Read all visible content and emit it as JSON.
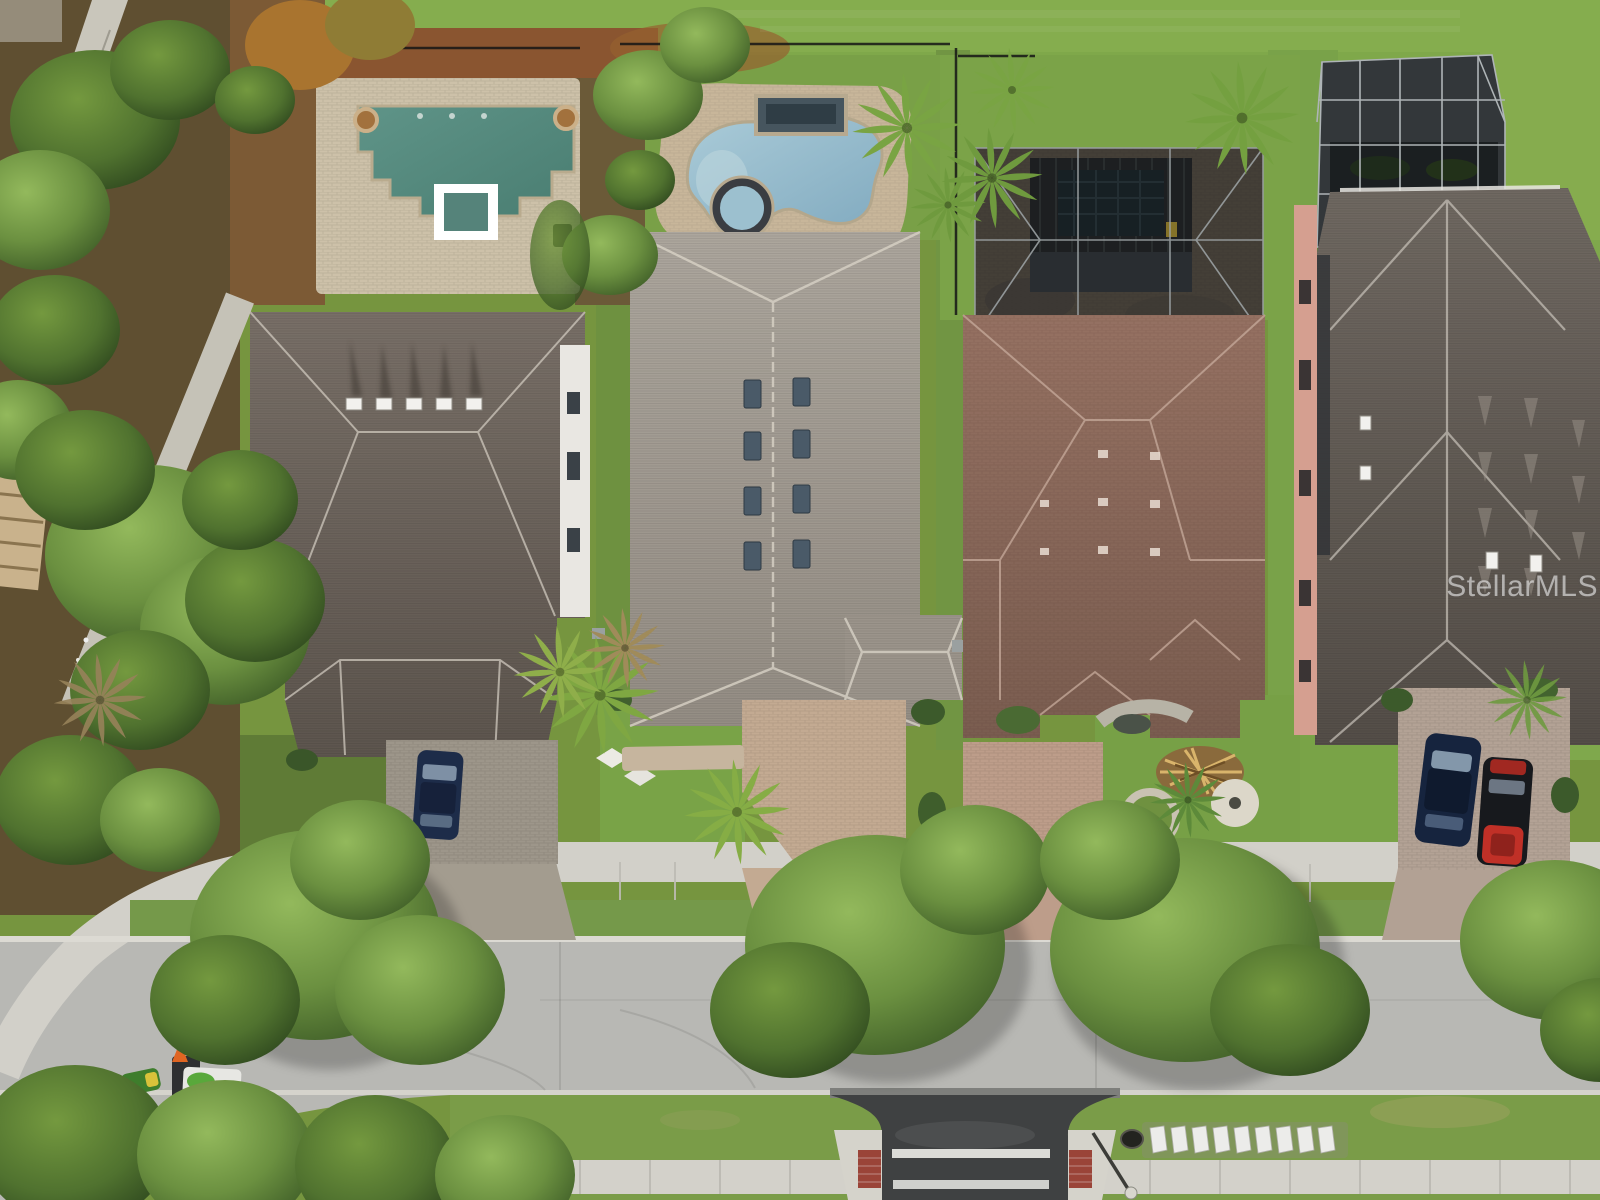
{
  "photo": {
    "kind": "aerial-drone-top-down",
    "subject": "Top-down aerial view of four suburban homes with backyard pools along a tree-lined residential street"
  },
  "watermark": {
    "text": "StellarMLS",
    "color": "#ffffff",
    "opacity": 0.55
  },
  "palette": {
    "lawn": "#7aa347",
    "lawn_bright": "#86ad4e",
    "mulch": "#6a5533",
    "street": "#b8b8b4",
    "sidewalk": "#d3d1ca",
    "pool1_water": "#558a7d",
    "pool2_water": "#9dc3d4",
    "pool_deck_paver": "#cdc1a9",
    "roof_house1": "#6e655d",
    "roof_house2": "#a39d94",
    "roof_house3": "#8a695a",
    "roof_house4": "#665f58",
    "screen_cage": "#33373a",
    "salmon_wall": "#d59f90",
    "white_wall": "#e9e7e2",
    "crosswalk_asphalt": "#3f4142",
    "brick_pad": "#9a4438",
    "navy_car": "#1d2c49",
    "navy_suv": "#16243e",
    "red_car": "#c03027",
    "mower_green": "#3e7d2c",
    "cone_orange": "#e06522"
  },
  "objects": {
    "property_1": [
      "ornate geometric pool with teal water",
      "white-bordered square spa",
      "two round fountain bowls",
      "tan paver pool deck",
      "black grill",
      "gray hip-roof house with five white roof vents",
      "white two-story side wall with windows",
      "gray paver driveway",
      "navy sedan"
    ],
    "property_2": [
      "freeform light-blue pool",
      "raised water-feature wall",
      "round spa",
      "tan paver deck",
      "black perimeter fence",
      "long gray shingle roof with eight skylights",
      "pink paver driveway",
      "yellow-green palm trees"
    ],
    "property_3": [
      "screened lanai courtyard with dark mesh",
      "rectangular plunge pool under black trellis",
      "mauve tile hip roof",
      "paver driveway",
      "stone circle and white gravel circle in front yard",
      "palm frond debris pile",
      "small rock pond"
    ],
    "property_4": [
      "tall screened pool cage with aluminum frame",
      "salmon stucco side wall",
      "large dark shingle roof with white vents",
      "paver driveway",
      "navy SUV",
      "red-and-black sports car"
    ],
    "street_scene": [
      "concrete sidewalks",
      "grass parkways",
      "concrete street",
      "brick-trimmed crosswalk with two white stripes",
      "row of white guard panels beside culvert",
      "street light",
      "green riding mower",
      "landscape trailer with white box and orange cone",
      "large shade tree canopies over street"
    ]
  }
}
